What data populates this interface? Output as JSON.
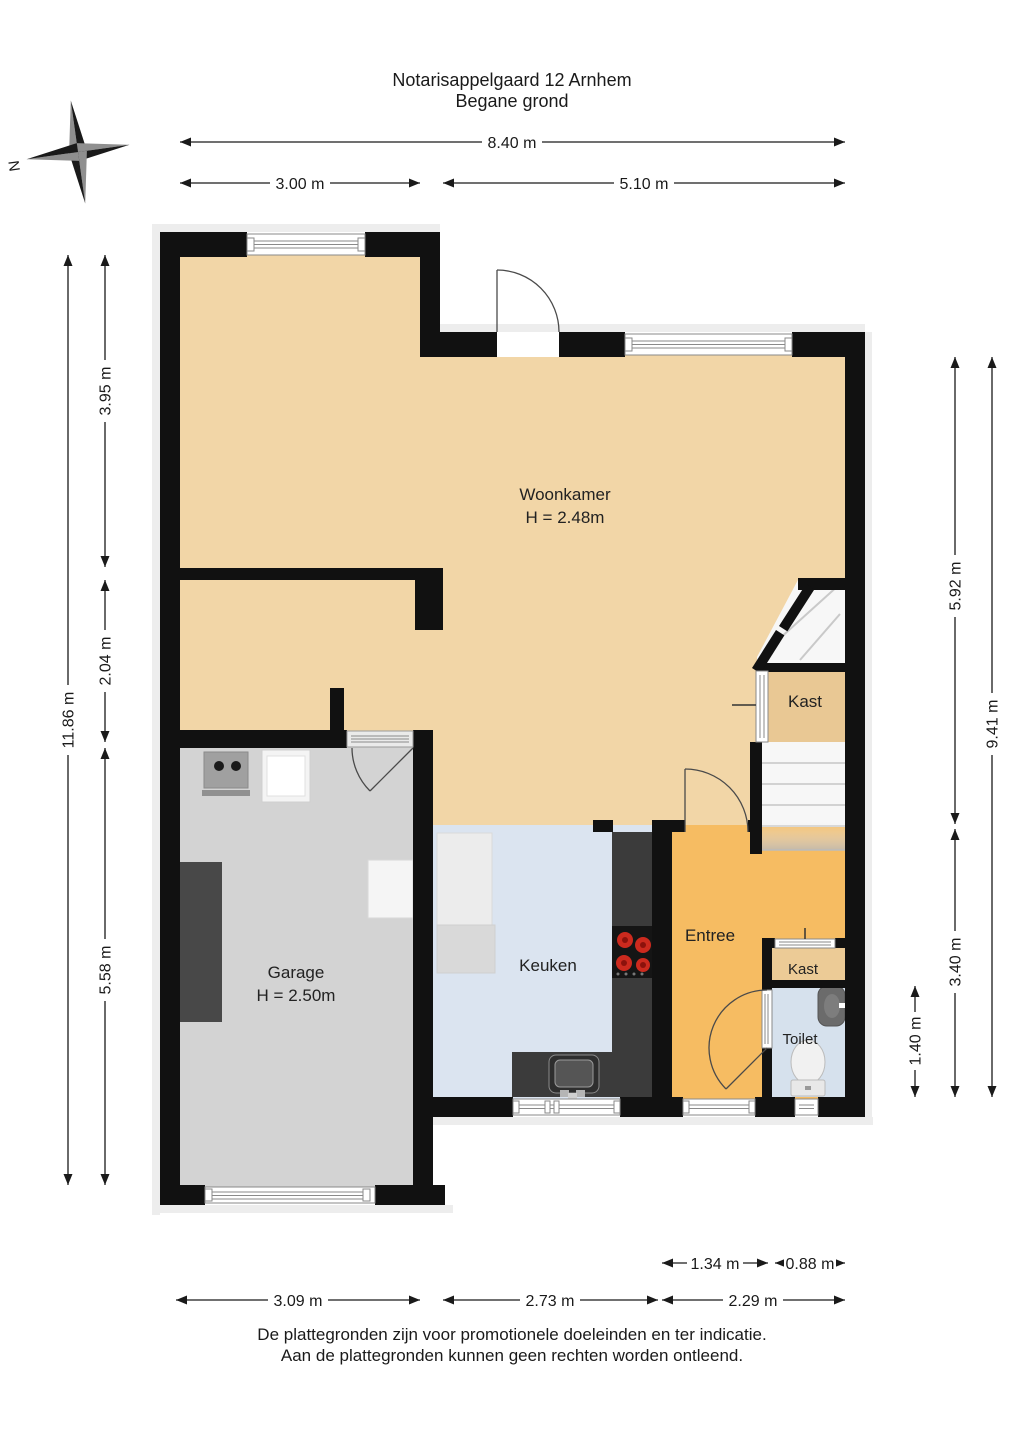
{
  "title": {
    "line1": "Notarisappelgaard 12 Arnhem",
    "line2": "Begane grond"
  },
  "compass": {
    "north": "N"
  },
  "rooms": {
    "woonkamer": {
      "label": "Woonkamer",
      "height": "H = 2.48m"
    },
    "garage": {
      "label": "Garage",
      "height": "H = 2.50m"
    },
    "keuken": {
      "label": "Keuken"
    },
    "entree": {
      "label": "Entree"
    },
    "kast_upper": {
      "label": "Kast"
    },
    "kast_lower": {
      "label": "Kast"
    },
    "toilet": {
      "label": "Toilet"
    }
  },
  "dims": {
    "top_total": "8.40 m",
    "top_left": "3.00 m",
    "top_right": "5.10 m",
    "left_total": "11.86 m",
    "left_upper": "3.95 m",
    "left_middle": "2.04 m",
    "left_lower": "5.58 m",
    "right_upper": "5.92 m",
    "right_lower": "3.40 m",
    "right_total": "9.41 m",
    "right_toilet": "1.40 m",
    "bottom_kast": "1.34 m",
    "bottom_toilet": "0.88 m",
    "bottom_garage": "3.09 m",
    "bottom_keuken": "2.73 m",
    "bottom_entree": "2.29 m"
  },
  "footer": {
    "line1": "De plattegronden zijn voor promotionele doeleinden en ter indicatie.",
    "line2": "Aan de plattegronden kunnen geen rechten worden ontleend."
  },
  "colors": {
    "woonkamer": "#f2d6a7",
    "kast": "#e9c894",
    "kast_lower": "#eccb96",
    "garage": "#d3d3d3",
    "keuken": "#dbe4f0",
    "entree": "#f6bc62",
    "toilet": "#d6e1ed",
    "wall": "#111111",
    "counter": "#3b3b3b",
    "burner": "#cc2a1e",
    "stairs": "#f4f4f4"
  }
}
